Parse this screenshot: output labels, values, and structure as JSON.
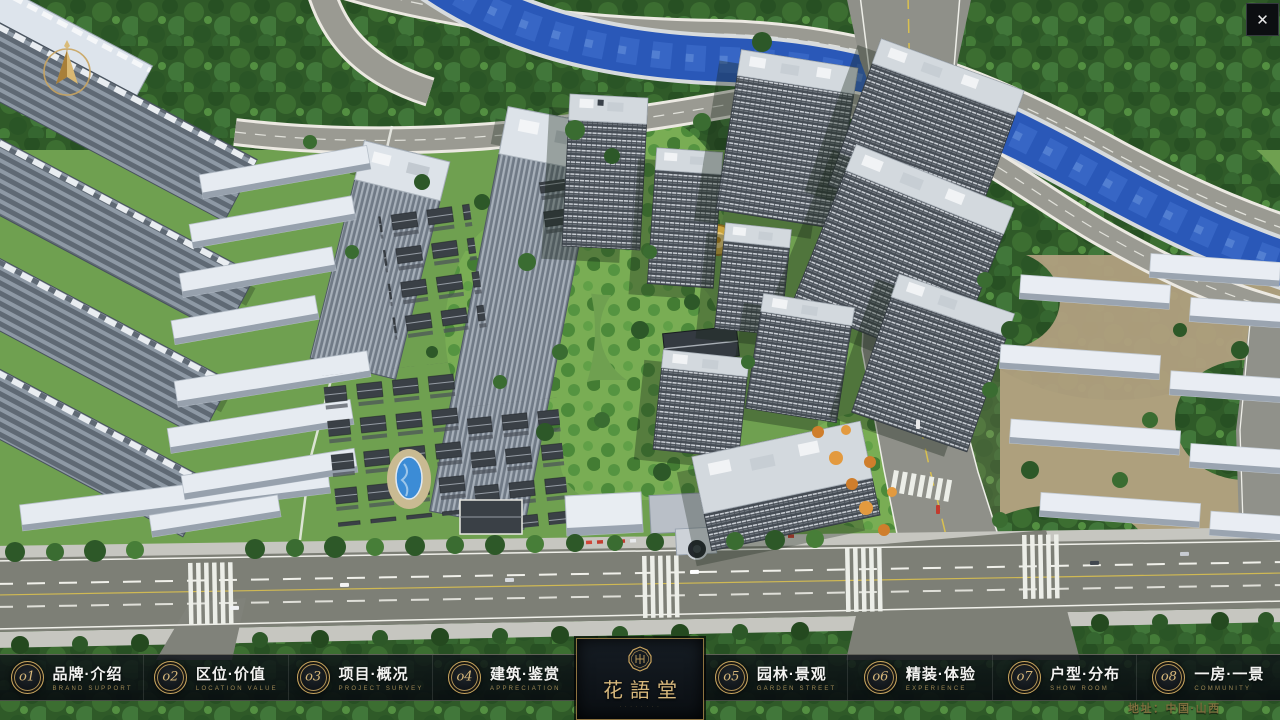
{
  "app": {
    "close_glyph": "✕"
  },
  "nav": {
    "items": [
      {
        "num": "o1",
        "cn": "品牌·介绍",
        "en": "BRAND SUPPORT"
      },
      {
        "num": "o2",
        "cn": "区位·价值",
        "en": "LOCATION VALUE"
      },
      {
        "num": "o3",
        "cn": "项目·概况",
        "en": "PROJECT SURVEY"
      },
      {
        "num": "o4",
        "cn": "建筑·鉴赏",
        "en": "APPRECIATION"
      },
      {
        "num": "o5",
        "cn": "园林·景观",
        "en": "GARDEN STREET"
      },
      {
        "num": "o6",
        "cn": "精装·体验",
        "en": "EXPERIENCE"
      },
      {
        "num": "o7",
        "cn": "户型·分布",
        "en": "SHOW ROOM"
      },
      {
        "num": "o8",
        "cn": "一房·一景",
        "en": "COMMUNITY"
      }
    ]
  },
  "logo": {
    "title": "花語堂",
    "subtitle": "· · · · · · · ·"
  },
  "footer": {
    "address": "地址：中国·山西"
  },
  "colors": {
    "accent_gold": "#c9a65f",
    "bar_background": "#0b1015",
    "river_blue": "#2a58b8",
    "grass_green": "#699a4b",
    "text_white": "#f3f3f1",
    "text_gold": "#9d8753"
  }
}
